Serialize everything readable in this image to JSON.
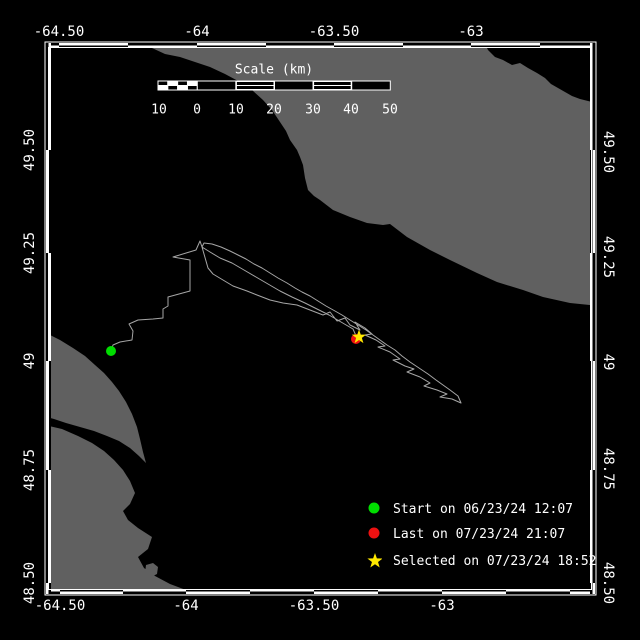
{
  "colors": {
    "background": "#000000",
    "land": "#606060",
    "water": "#000000",
    "frame": "#ffffff",
    "track": "#a6a6a6",
    "start_marker": "#00dd00",
    "last_marker": "#ee1111",
    "selected_marker": "#ffe800",
    "text": "#ffffff"
  },
  "axes": {
    "top_labels": [
      "-64.50",
      "-64",
      "-63.50",
      "-63"
    ],
    "bottom_labels": [
      "-64.50",
      "-64",
      "-63.50",
      "-63"
    ],
    "left_labels": [
      "49.50",
      "49.25",
      "49",
      "48.75",
      "48.50"
    ],
    "right_labels": [
      "49.50",
      "49.25",
      "49",
      "48.75",
      "48.50"
    ]
  },
  "scale_bar": {
    "title": "Scale (km)",
    "tick_labels": [
      "10",
      "0",
      "10",
      "20",
      "30",
      "40",
      "50"
    ]
  },
  "legend": {
    "items": [
      {
        "marker": "circle",
        "color": "#00dd00",
        "label": "Start on 06/23/24 12:07"
      },
      {
        "marker": "circle",
        "color": "#ee1111",
        "label": "Last on 07/23/24 21:07"
      },
      {
        "marker": "star",
        "color": "#ffe800",
        "label": "Selected on 07/23/24 18:52"
      }
    ]
  },
  "map": {
    "markers": {
      "start": {
        "x": 111,
        "y": 351
      },
      "last": {
        "x": 356,
        "y": 339
      },
      "selected": {
        "x": 359,
        "y": 337
      }
    },
    "land_polygons": [
      [
        [
          150,
          40
        ],
        [
          483,
          40
        ],
        [
          488,
          50
        ],
        [
          495,
          57
        ],
        [
          503,
          60
        ],
        [
          512,
          65
        ],
        [
          520,
          63
        ],
        [
          528,
          68
        ],
        [
          537,
          73
        ],
        [
          545,
          78
        ],
        [
          551,
          84
        ],
        [
          558,
          88
        ],
        [
          565,
          92
        ],
        [
          572,
          96
        ],
        [
          580,
          99
        ],
        [
          588,
          101
        ],
        [
          600,
          104
        ],
        [
          600,
          306
        ],
        [
          570,
          303
        ],
        [
          543,
          297
        ],
        [
          523,
          290
        ],
        [
          497,
          282
        ],
        [
          477,
          273
        ],
        [
          450,
          260
        ],
        [
          430,
          250
        ],
        [
          407,
          237
        ],
        [
          390,
          224
        ],
        [
          383,
          225
        ],
        [
          367,
          223
        ],
        [
          350,
          217
        ],
        [
          333,
          210
        ],
        [
          320,
          200
        ],
        [
          314,
          196
        ],
        [
          308,
          190
        ],
        [
          305,
          178
        ],
        [
          303,
          165
        ],
        [
          300,
          157
        ],
        [
          297,
          150
        ],
        [
          290,
          140
        ],
        [
          286,
          131
        ],
        [
          280,
          122
        ],
        [
          272,
          110
        ],
        [
          263,
          100
        ],
        [
          252,
          90
        ],
        [
          240,
          82
        ],
        [
          225,
          74
        ],
        [
          210,
          67
        ],
        [
          195,
          62
        ],
        [
          180,
          57
        ],
        [
          165,
          54
        ],
        [
          152,
          48
        ]
      ],
      [
        [
          40,
          330
        ],
        [
          60,
          340
        ],
        [
          73,
          348
        ],
        [
          85,
          356
        ],
        [
          95,
          365
        ],
        [
          104,
          373
        ],
        [
          112,
          382
        ],
        [
          119,
          391
        ],
        [
          126,
          402
        ],
        [
          132,
          414
        ],
        [
          137,
          427
        ],
        [
          140,
          439
        ],
        [
          143,
          452
        ],
        [
          146,
          463
        ],
        [
          139,
          456
        ],
        [
          130,
          448
        ],
        [
          119,
          441
        ],
        [
          107,
          436
        ],
        [
          94,
          431
        ],
        [
          80,
          427
        ],
        [
          66,
          423
        ],
        [
          54,
          419
        ],
        [
          40,
          415
        ]
      ],
      [
        [
          40,
          424
        ],
        [
          62,
          429
        ],
        [
          78,
          436
        ],
        [
          92,
          443
        ],
        [
          104,
          451
        ],
        [
          114,
          460
        ],
        [
          123,
          470
        ],
        [
          130,
          481
        ],
        [
          135,
          493
        ],
        [
          130,
          504
        ],
        [
          123,
          511
        ],
        [
          128,
          520
        ],
        [
          138,
          528
        ],
        [
          152,
          537
        ],
        [
          148,
          549
        ],
        [
          138,
          557
        ],
        [
          144,
          568
        ],
        [
          155,
          576
        ],
        [
          170,
          584
        ],
        [
          186,
          590
        ],
        [
          205,
          598
        ],
        [
          40,
          598
        ]
      ],
      [
        [
          146,
          565
        ],
        [
          153,
          563
        ],
        [
          158,
          567
        ],
        [
          157,
          574
        ],
        [
          151,
          577
        ],
        [
          145,
          573
        ]
      ]
    ],
    "track_points": [
      [
        111,
        351
      ],
      [
        113,
        345
      ],
      [
        120,
        342
      ],
      [
        132,
        340
      ],
      [
        133,
        331
      ],
      [
        129,
        324
      ],
      [
        138,
        320
      ],
      [
        153,
        319
      ],
      [
        163,
        318
      ],
      [
        163,
        309
      ],
      [
        168,
        306
      ],
      [
        168,
        297
      ],
      [
        190,
        291
      ],
      [
        190,
        260
      ],
      [
        173,
        257
      ],
      [
        196,
        250
      ],
      [
        200,
        241
      ],
      [
        202,
        247
      ],
      [
        208,
        268
      ],
      [
        213,
        274
      ],
      [
        223,
        280
      ],
      [
        233,
        286
      ],
      [
        247,
        291
      ],
      [
        257,
        295
      ],
      [
        270,
        300
      ],
      [
        283,
        303
      ],
      [
        297,
        305
      ],
      [
        310,
        310
      ],
      [
        323,
        315
      ],
      [
        330,
        312
      ],
      [
        337,
        321
      ],
      [
        345,
        318
      ],
      [
        350,
        325
      ],
      [
        360,
        330
      ],
      [
        355,
        322
      ],
      [
        365,
        328
      ],
      [
        372,
        334
      ],
      [
        365,
        335
      ],
      [
        376,
        340
      ],
      [
        385,
        346
      ],
      [
        378,
        347
      ],
      [
        390,
        352
      ],
      [
        400,
        359
      ],
      [
        393,
        360
      ],
      [
        405,
        366
      ],
      [
        414,
        369
      ],
      [
        407,
        372
      ],
      [
        420,
        377
      ],
      [
        430,
        383
      ],
      [
        424,
        386
      ],
      [
        437,
        390
      ],
      [
        447,
        394
      ],
      [
        440,
        397
      ],
      [
        452,
        399
      ],
      [
        461,
        403
      ],
      [
        458,
        396
      ],
      [
        450,
        390
      ],
      [
        443,
        385
      ],
      [
        436,
        380
      ],
      [
        428,
        374
      ],
      [
        419,
        368
      ],
      [
        410,
        362
      ],
      [
        402,
        356
      ],
      [
        395,
        350
      ],
      [
        387,
        345
      ],
      [
        380,
        340
      ],
      [
        373,
        335
      ],
      [
        366,
        330
      ],
      [
        358,
        325
      ],
      [
        350,
        320
      ],
      [
        342,
        315
      ],
      [
        335,
        311
      ],
      [
        326,
        306
      ],
      [
        318,
        301
      ],
      [
        310,
        296
      ],
      [
        302,
        292
      ],
      [
        295,
        288
      ],
      [
        287,
        283
      ],
      [
        278,
        278
      ],
      [
        270,
        273
      ],
      [
        262,
        268
      ],
      [
        254,
        264
      ],
      [
        246,
        259
      ],
      [
        238,
        255
      ],
      [
        230,
        251
      ],
      [
        221,
        247
      ],
      [
        212,
        244
      ],
      [
        204,
        243
      ],
      [
        202,
        247
      ],
      [
        210,
        252
      ],
      [
        220,
        258
      ],
      [
        232,
        263
      ],
      [
        244,
        270
      ],
      [
        256,
        277
      ],
      [
        268,
        284
      ],
      [
        280,
        291
      ],
      [
        292,
        297
      ],
      [
        305,
        303
      ],
      [
        317,
        309
      ],
      [
        329,
        315
      ],
      [
        341,
        322
      ],
      [
        353,
        329
      ],
      [
        357,
        338
      ]
    ]
  }
}
